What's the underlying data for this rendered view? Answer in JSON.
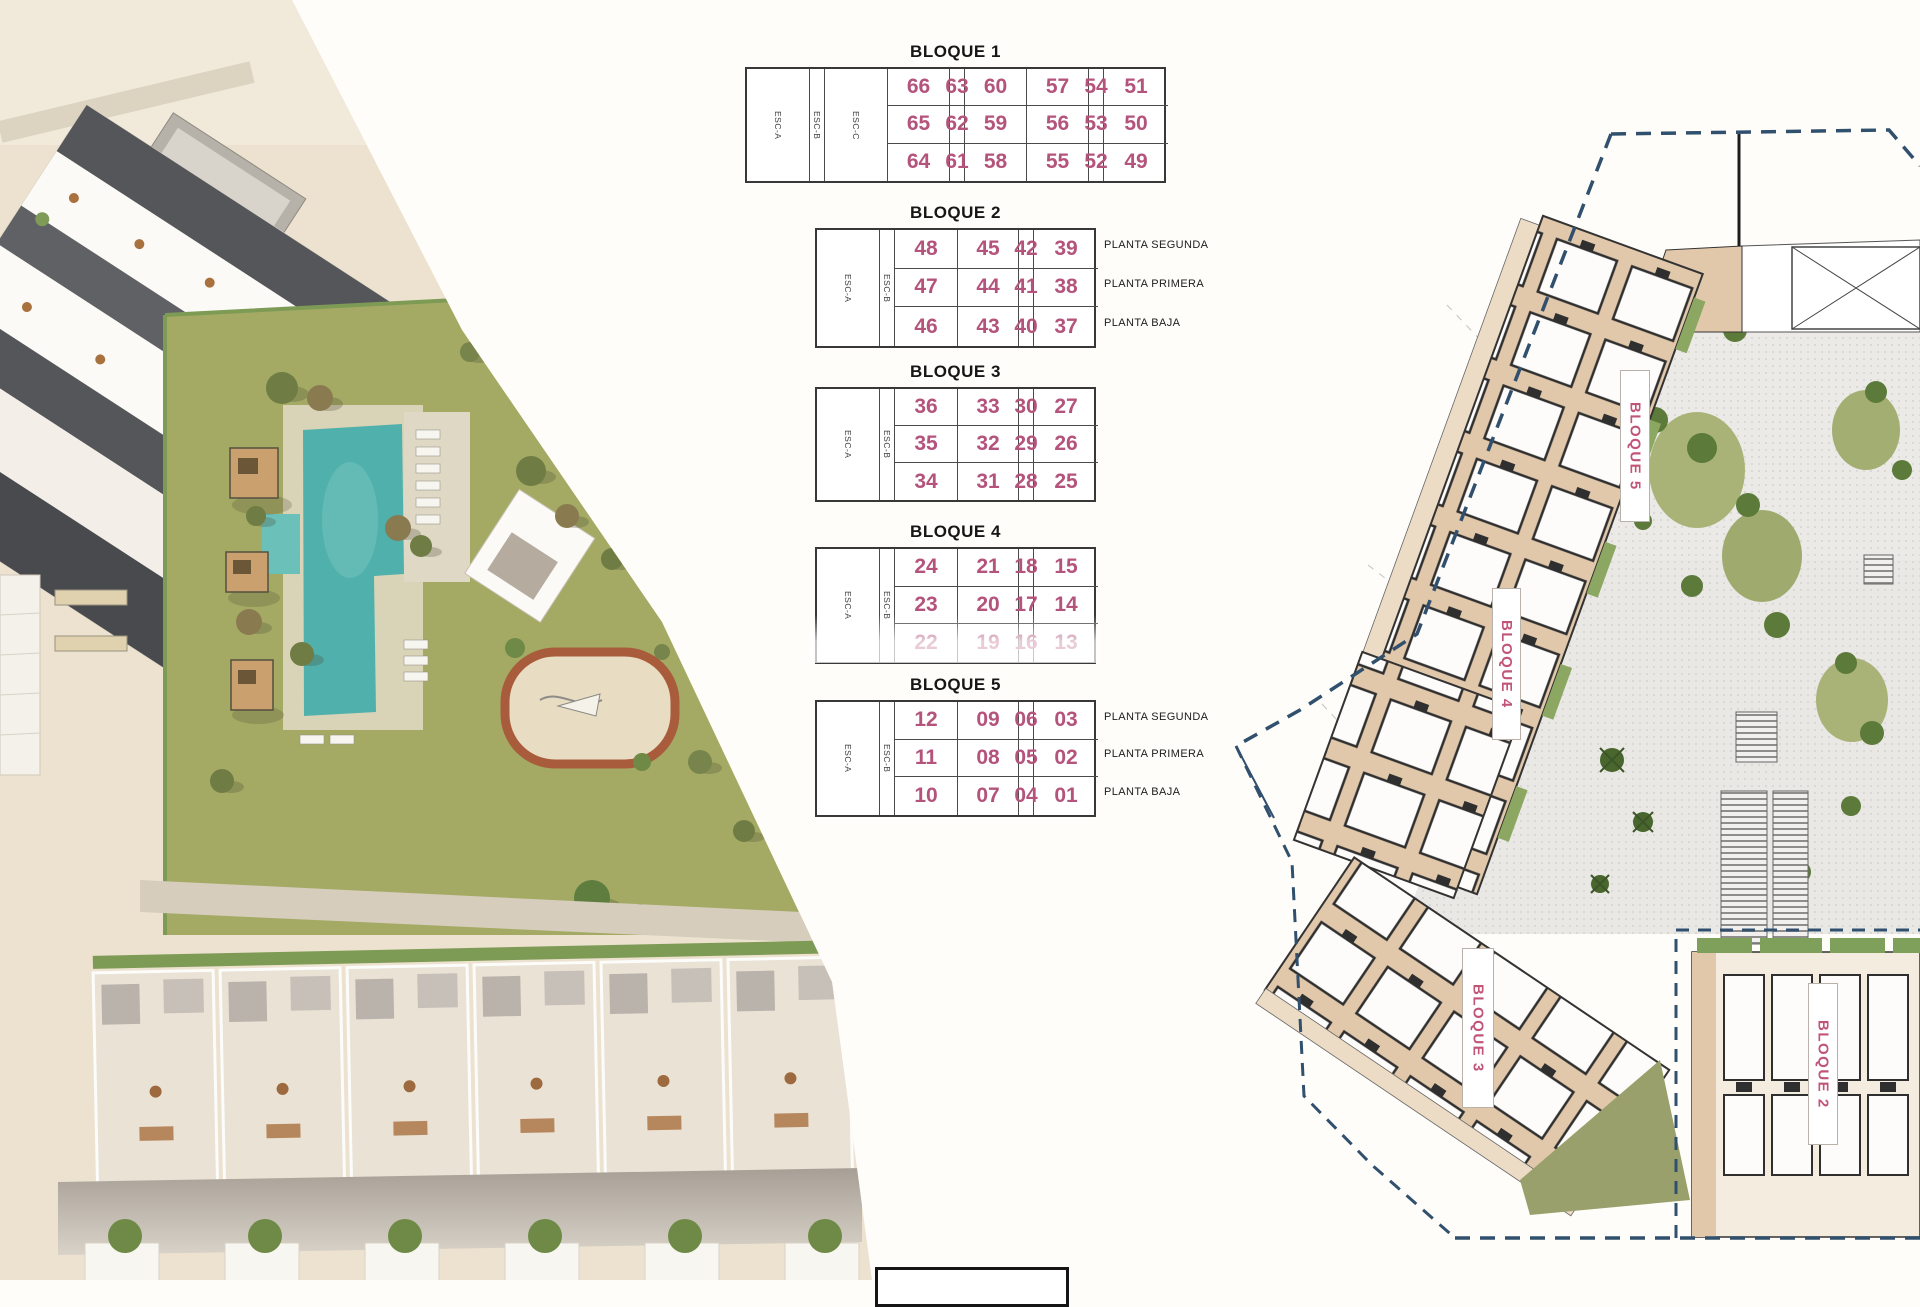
{
  "colors": {
    "accent_pink": "#b4537b",
    "boundary_navy": "#30506e",
    "building_tan": "#e2c8ab",
    "pool_teal": "#50b1ac",
    "grass_green": "#a4aa64"
  },
  "tables": [
    {
      "id": "bloque1",
      "title": "BLOQUE 1",
      "columns": [
        {
          "type": "units",
          "values": [
            "66",
            "65",
            "64"
          ]
        },
        {
          "type": "esc",
          "label": "ESC-A"
        },
        {
          "type": "units",
          "values": [
            "63",
            "62",
            "61"
          ]
        },
        {
          "type": "units",
          "values": [
            "60",
            "59",
            "58"
          ]
        },
        {
          "type": "esc",
          "label": "ESC-B"
        },
        {
          "type": "units",
          "values": [
            "57",
            "56",
            "55"
          ]
        },
        {
          "type": "units",
          "values": [
            "54",
            "53",
            "52"
          ]
        },
        {
          "type": "esc",
          "label": "ESC-C"
        },
        {
          "type": "units",
          "values": [
            "51",
            "50",
            "49"
          ]
        }
      ],
      "floor_labels": []
    },
    {
      "id": "bloque2",
      "title": "BLOQUE 2",
      "columns": [
        {
          "type": "units",
          "values": [
            "48",
            "47",
            "46"
          ]
        },
        {
          "type": "esc",
          "label": "ESC-A"
        },
        {
          "type": "units",
          "values": [
            "45",
            "44",
            "43"
          ]
        },
        {
          "type": "units",
          "values": [
            "42",
            "41",
            "40"
          ]
        },
        {
          "type": "esc",
          "label": "ESC-B"
        },
        {
          "type": "units",
          "values": [
            "39",
            "38",
            "37"
          ]
        }
      ],
      "floor_labels": [
        "PLANTA SEGUNDA",
        "PLANTA PRIMERA",
        "PLANTA BAJA"
      ]
    },
    {
      "id": "bloque3",
      "title": "BLOQUE 3",
      "columns": [
        {
          "type": "units",
          "values": [
            "36",
            "35",
            "34"
          ]
        },
        {
          "type": "esc",
          "label": "ESC-A"
        },
        {
          "type": "units",
          "values": [
            "33",
            "32",
            "31"
          ]
        },
        {
          "type": "units",
          "values": [
            "30",
            "29",
            "28"
          ]
        },
        {
          "type": "esc",
          "label": "ESC-B"
        },
        {
          "type": "units",
          "values": [
            "27",
            "26",
            "25"
          ]
        }
      ],
      "floor_labels": []
    },
    {
      "id": "bloque4",
      "title": "BLOQUE 4",
      "columns": [
        {
          "type": "units",
          "values": [
            "24",
            "23",
            "22"
          ]
        },
        {
          "type": "esc",
          "label": "ESC-A"
        },
        {
          "type": "units",
          "values": [
            "21",
            "20",
            "19"
          ]
        },
        {
          "type": "units",
          "values": [
            "18",
            "17",
            "16"
          ]
        },
        {
          "type": "esc",
          "label": "ESC-B"
        },
        {
          "type": "units",
          "values": [
            "15",
            "14",
            "13"
          ]
        }
      ],
      "floor_labels": []
    },
    {
      "id": "bloque5",
      "title": "BLOQUE 5",
      "columns": [
        {
          "type": "units",
          "values": [
            "12",
            "11",
            "10"
          ]
        },
        {
          "type": "esc",
          "label": "ESC-A"
        },
        {
          "type": "units",
          "values": [
            "09",
            "08",
            "07"
          ]
        },
        {
          "type": "units",
          "values": [
            "06",
            "05",
            "04"
          ]
        },
        {
          "type": "esc",
          "label": "ESC-B"
        },
        {
          "type": "units",
          "values": [
            "03",
            "02",
            "01"
          ]
        }
      ],
      "floor_labels": [
        "PLANTA SEGUNDA",
        "PLANTA PRIMERA",
        "PLANTA BAJA"
      ]
    }
  ],
  "site_plan": {
    "block_labels": [
      {
        "label": "BLOQUE 5"
      },
      {
        "label": "BLOQUE 4"
      },
      {
        "label": "BLOQUE 3"
      },
      {
        "label": "BLOQUE 2"
      }
    ]
  }
}
